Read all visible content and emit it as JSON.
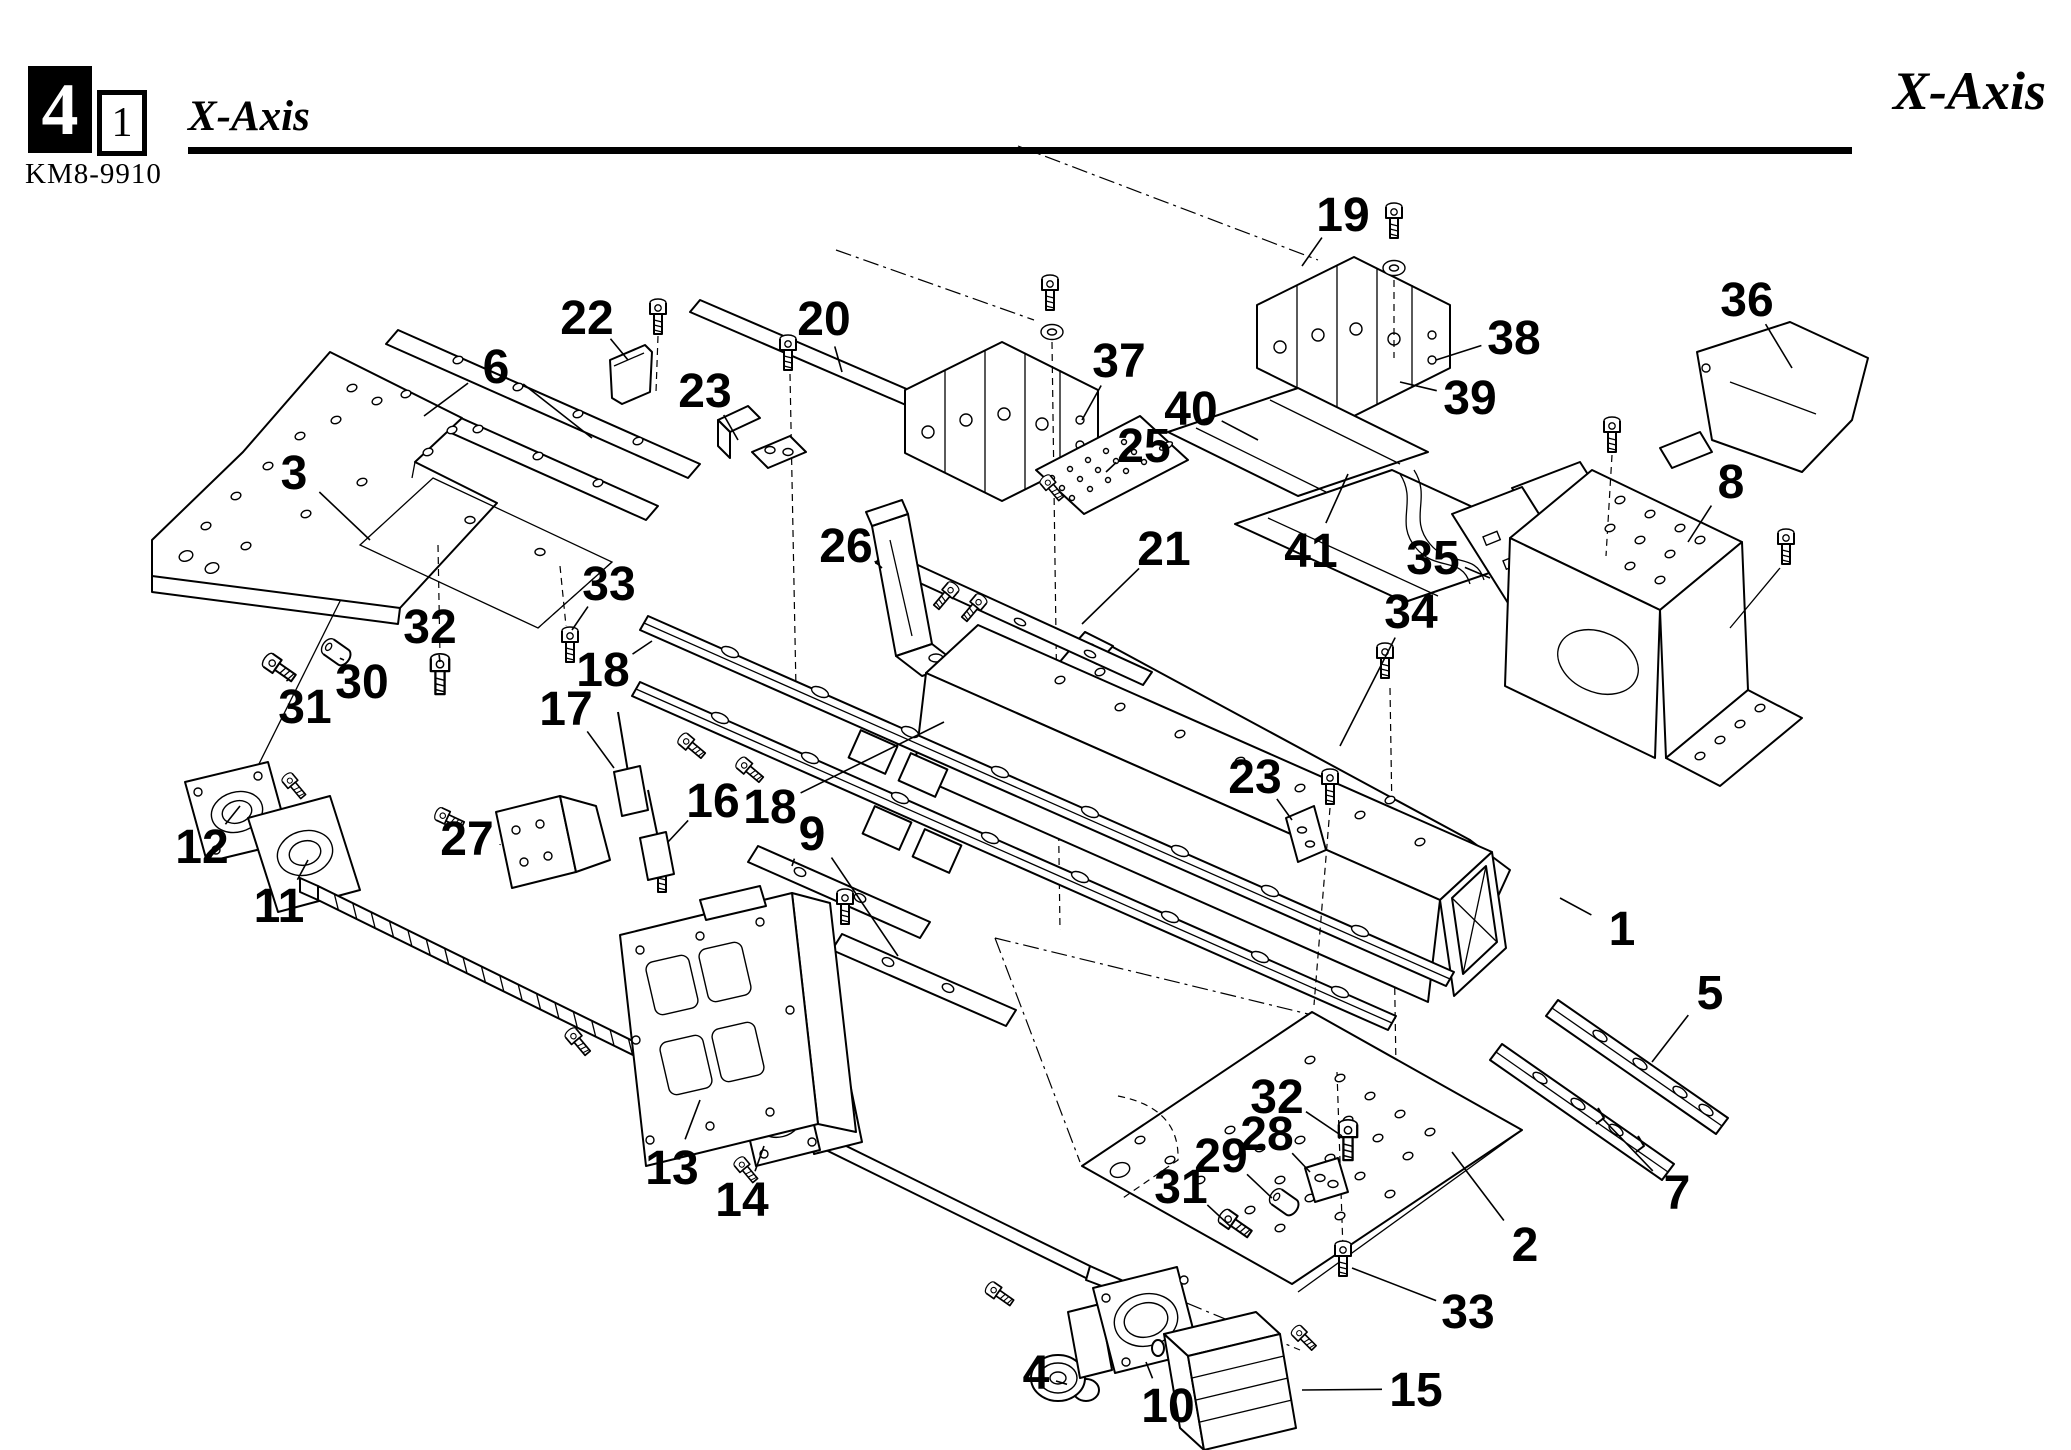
{
  "header": {
    "section_number": "4",
    "subsection_number": "1",
    "doc_code": "KM8-9910",
    "title": "X-Axis",
    "title_right": "X-Axis"
  },
  "diagram": {
    "description": "Exploded parts diagram of the X-Axis assembly",
    "part_labels": [
      {
        "n": "1",
        "x": 1622,
        "y": 928,
        "to": [
          [
            1560,
            898
          ]
        ]
      },
      {
        "n": "2",
        "x": 1525,
        "y": 1244,
        "to": [
          [
            1452,
            1152
          ]
        ]
      },
      {
        "n": "3",
        "x": 294,
        "y": 472,
        "to": [
          [
            370,
            540
          ]
        ]
      },
      {
        "n": "4",
        "x": 1036,
        "y": 1372,
        "to": [
          [
            1056,
            1381
          ]
        ]
      },
      {
        "n": "5",
        "x": 1710,
        "y": 992,
        "to": [
          [
            1652,
            1062
          ]
        ]
      },
      {
        "n": "6",
        "x": 496,
        "y": 366,
        "to": [
          [
            424,
            416
          ],
          [
            592,
            438
          ]
        ]
      },
      {
        "n": "7",
        "x": 1677,
        "y": 1192,
        "to": [
          [
            1602,
            1118
          ]
        ]
      },
      {
        "n": "8",
        "x": 1731,
        "y": 481,
        "to": [
          [
            1688,
            542
          ]
        ]
      },
      {
        "n": "9",
        "x": 812,
        "y": 833,
        "to": [
          [
            792,
            866
          ],
          [
            898,
            956
          ]
        ]
      },
      {
        "n": "10",
        "x": 1168,
        "y": 1405,
        "to": [
          [
            1146,
            1362
          ]
        ]
      },
      {
        "n": "11",
        "x": 279,
        "y": 905,
        "to": [
          [
            308,
            860
          ]
        ]
      },
      {
        "n": "12",
        "x": 202,
        "y": 846,
        "to": [
          [
            240,
            806
          ]
        ]
      },
      {
        "n": "13",
        "x": 672,
        "y": 1167,
        "to": [
          [
            700,
            1100
          ]
        ]
      },
      {
        "n": "14",
        "x": 742,
        "y": 1199,
        "to": [
          [
            764,
            1146
          ]
        ]
      },
      {
        "n": "15",
        "x": 1416,
        "y": 1389,
        "to": [
          [
            1302,
            1390
          ]
        ]
      },
      {
        "n": "16",
        "x": 713,
        "y": 800,
        "to": [
          [
            668,
            842
          ]
        ]
      },
      {
        "n": "17",
        "x": 566,
        "y": 708,
        "to": [
          [
            614,
            768
          ]
        ]
      },
      {
        "n": "18",
        "x": 603,
        "y": 669,
        "to": [
          [
            652,
            641
          ]
        ]
      },
      {
        "n": "18",
        "x": 770,
        "y": 806,
        "to": [
          [
            944,
            722
          ]
        ]
      },
      {
        "n": "19",
        "x": 1343,
        "y": 214,
        "to": [
          [
            1302,
            266
          ]
        ]
      },
      {
        "n": "20",
        "x": 824,
        "y": 318,
        "to": [
          [
            842,
            372
          ]
        ]
      },
      {
        "n": "21",
        "x": 1164,
        "y": 548,
        "to": [
          [
            1082,
            624
          ]
        ]
      },
      {
        "n": "22",
        "x": 587,
        "y": 317,
        "to": [
          [
            628,
            360
          ]
        ]
      },
      {
        "n": "23",
        "x": 705,
        "y": 390,
        "to": [
          [
            738,
            440
          ]
        ]
      },
      {
        "n": "23",
        "x": 1255,
        "y": 776,
        "to": [
          [
            1292,
            820
          ]
        ]
      },
      {
        "n": "25",
        "x": 1144,
        "y": 445,
        "to": [
          [
            1106,
            472
          ]
        ]
      },
      {
        "n": "26",
        "x": 846,
        "y": 545,
        "to": [
          [
            882,
            568
          ]
        ]
      },
      {
        "n": "27",
        "x": 467,
        "y": 838,
        "to": [
          [
            500,
            845
          ]
        ]
      },
      {
        "n": "28",
        "x": 1267,
        "y": 1133,
        "to": [
          [
            1310,
            1172
          ]
        ]
      },
      {
        "n": "29",
        "x": 1221,
        "y": 1155,
        "to": [
          [
            1272,
            1198
          ]
        ]
      },
      {
        "n": "30",
        "x": 362,
        "y": 681,
        "to": [
          [
            344,
            660
          ]
        ]
      },
      {
        "n": "31",
        "x": 305,
        "y": 706,
        "to": [
          [
            288,
            680
          ]
        ]
      },
      {
        "n": "31",
        "x": 1181,
        "y": 1186,
        "to": [
          [
            1230,
            1226
          ]
        ]
      },
      {
        "n": "32",
        "x": 430,
        "y": 626,
        "to": [
          [
            440,
            662
          ]
        ]
      },
      {
        "n": "32",
        "x": 1277,
        "y": 1096,
        "to": [
          [
            1342,
            1136
          ]
        ]
      },
      {
        "n": "33",
        "x": 609,
        "y": 583,
        "to": [
          [
            572,
            630
          ]
        ]
      },
      {
        "n": "33",
        "x": 1468,
        "y": 1311,
        "to": [
          [
            1352,
            1268
          ]
        ]
      },
      {
        "n": "34",
        "x": 1411,
        "y": 611,
        "to": [
          [
            1340,
            746
          ]
        ]
      },
      {
        "n": "35",
        "x": 1433,
        "y": 557,
        "to": [
          [
            1490,
            578
          ]
        ]
      },
      {
        "n": "36",
        "x": 1747,
        "y": 299,
        "to": [
          [
            1792,
            368
          ]
        ]
      },
      {
        "n": "37",
        "x": 1119,
        "y": 360,
        "to": [
          [
            1082,
            420
          ]
        ]
      },
      {
        "n": "38",
        "x": 1514,
        "y": 337,
        "to": [
          [
            1436,
            360
          ]
        ]
      },
      {
        "n": "39",
        "x": 1470,
        "y": 397,
        "to": [
          [
            1400,
            382
          ]
        ]
      },
      {
        "n": "40",
        "x": 1191,
        "y": 408,
        "to": [
          [
            1258,
            440
          ]
        ]
      },
      {
        "n": "41",
        "x": 1311,
        "y": 550,
        "to": [
          [
            1348,
            474
          ]
        ]
      }
    ]
  }
}
